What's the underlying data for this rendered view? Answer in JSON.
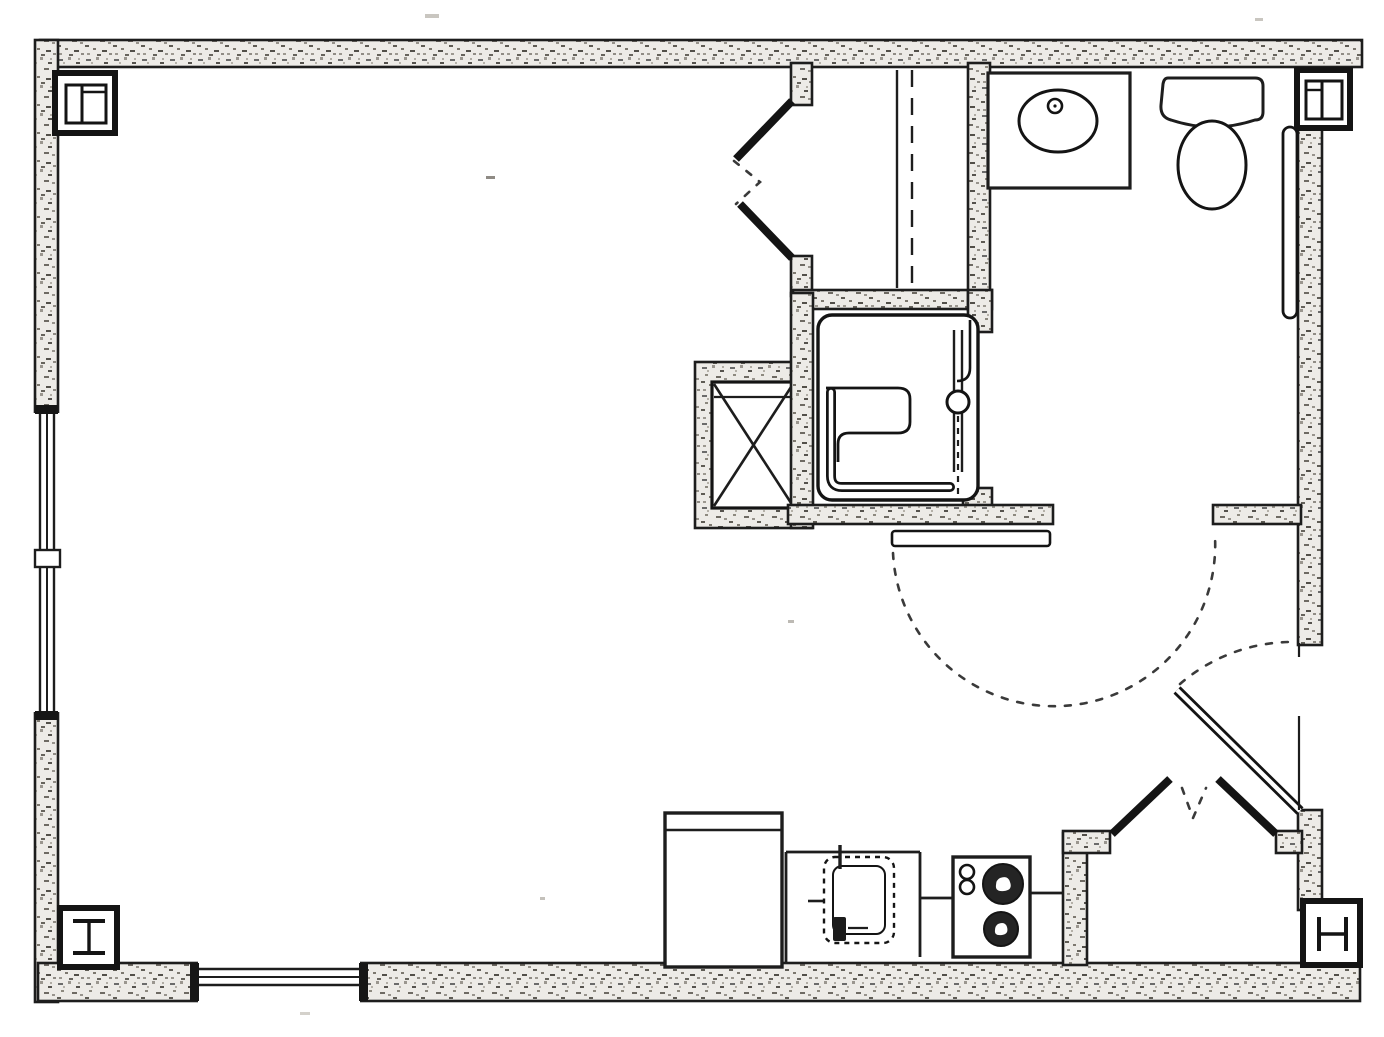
{
  "document": {
    "type": "scanned architectural floor plan",
    "title": "Studio apartment unit plan",
    "visible_text": [],
    "style": "black ink line drawing on white paper, stippled wall poche"
  },
  "palette": {
    "paper": "#ffffff",
    "ink": "#1d1d1d",
    "wall_fill": "#edebe7",
    "door_swing_dash": "#3a3a3a"
  },
  "rooms": [
    {
      "name": "main-living-room",
      "position": "left two-thirds, open floor"
    },
    {
      "name": "bathroom",
      "position": "top right"
    },
    {
      "name": "closet",
      "position": "top middle, bifold door, rod and shelf lines"
    },
    {
      "name": "mechanical-chase",
      "position": "middle, box with X"
    },
    {
      "name": "kitchen-strip",
      "position": "bottom middle"
    },
    {
      "name": "entry-vestibule-closet",
      "position": "bottom right, double bifold doors"
    }
  ],
  "fixtures": [
    {
      "name": "bathroom-vanity-sink",
      "shape": "rectangle with oval basin and faucet dot"
    },
    {
      "name": "toilet",
      "shape": "tank rectangle with oval bowl"
    },
    {
      "name": "grab-bar",
      "location": "right bathroom wall beside toilet"
    },
    {
      "name": "roll-in-shower",
      "details": "rounded pan, L grab bar, fold seat, slide rail with head"
    },
    {
      "name": "refrigerator",
      "location": "kitchen left"
    },
    {
      "name": "kitchen-sink",
      "shape": "dashed rounded square with faucet"
    },
    {
      "name": "cooktop",
      "burners": 2,
      "knobs": 2
    }
  ],
  "doors": [
    {
      "name": "closet-bifold-door",
      "type": "bifold",
      "location": "closet west side"
    },
    {
      "name": "bathroom-sliding-door",
      "type": "sliding panel with dashed swing arc"
    },
    {
      "name": "entry-door",
      "type": "swing door, shown open with dashed arc",
      "location": "east wall"
    },
    {
      "name": "entry-closet-double-bifold",
      "type": "pair of bifold leaves with dashed fold mark"
    }
  ],
  "windows": [
    {
      "name": "west-window",
      "wall": "west",
      "detail": "triple glazing lines with center mullion"
    },
    {
      "name": "south-window",
      "wall": "south left",
      "detail": "triple glazing lines"
    }
  ],
  "columns": [
    {
      "name": "column-north-west",
      "symbol": "divided square"
    },
    {
      "name": "column-north-east",
      "symbol": "divided square"
    },
    {
      "name": "column-south-west",
      "symbol": "I-beam section"
    },
    {
      "name": "column-south-east",
      "symbol": "I-beam section"
    }
  ]
}
